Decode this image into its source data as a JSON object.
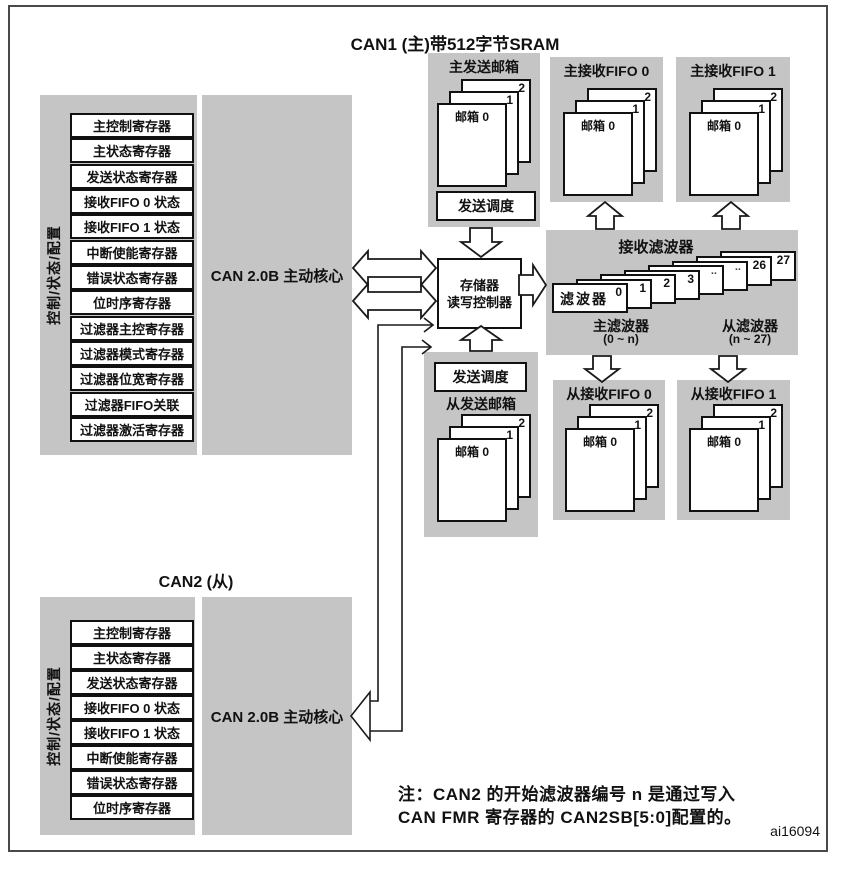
{
  "diagram": {
    "can1_title": "CAN1 (主)带512字节SRAM",
    "can2_title": "CAN2 (从)",
    "side_label": "控制/状态/配置",
    "core_label": "CAN 2.0B 主动核心",
    "can1_registers": [
      "主控制寄存器",
      "主状态寄存器",
      "发送状态寄存器",
      "接收FIFO 0 状态",
      "接收FIFO 1 状态",
      "中断使能寄存器",
      "错误状态寄存器",
      "位时序寄存器",
      "过滤器主控寄存器",
      "过滤器模式寄存器",
      "过滤器位宽寄存器",
      "过滤器FIFO关联",
      "过滤器激活寄存器"
    ],
    "can2_registers": [
      "主控制寄存器",
      "主状态寄存器",
      "发送状态寄存器",
      "接收FIFO 0 状态",
      "接收FIFO 1 状态",
      "中断使能寄存器",
      "错误状态寄存器",
      "位时序寄存器"
    ],
    "tx_mailbox_master_title": "主发送邮箱",
    "tx_mailbox_slave_title": "从发送邮箱",
    "tx_scheduler": "发送调度",
    "memory_controller": {
      "line1": "存储器",
      "line2": "读写控制器"
    },
    "rx_fifo": {
      "master0": "主接收FIFO 0",
      "master1": "主接收FIFO 1",
      "slave0": "从接收FIFO 0",
      "slave1": "从接收FIFO 1"
    },
    "mailbox": {
      "front": "邮箱 0",
      "mid": "1",
      "back": "2"
    },
    "filters": {
      "title": "接收滤波器",
      "front_name": "滤波器",
      "numbers": [
        "0",
        "1",
        "2",
        "3",
        "..",
        "..",
        "26",
        "27"
      ],
      "master_label": "主滤波器",
      "master_range": "(0 ~ n)",
      "slave_label": "从滤波器",
      "slave_range": "(n ~ 27)"
    },
    "note_line1": "注：CAN2 的开始滤波器编号 n 是通过写入",
    "note_line2": "CAN  FMR 寄存器的 CAN2SB[5:0]配置的。",
    "figure_id": "ai16094",
    "colors": {
      "panel_gray": "#c5c5c5",
      "line": "#1a1a1a"
    }
  }
}
